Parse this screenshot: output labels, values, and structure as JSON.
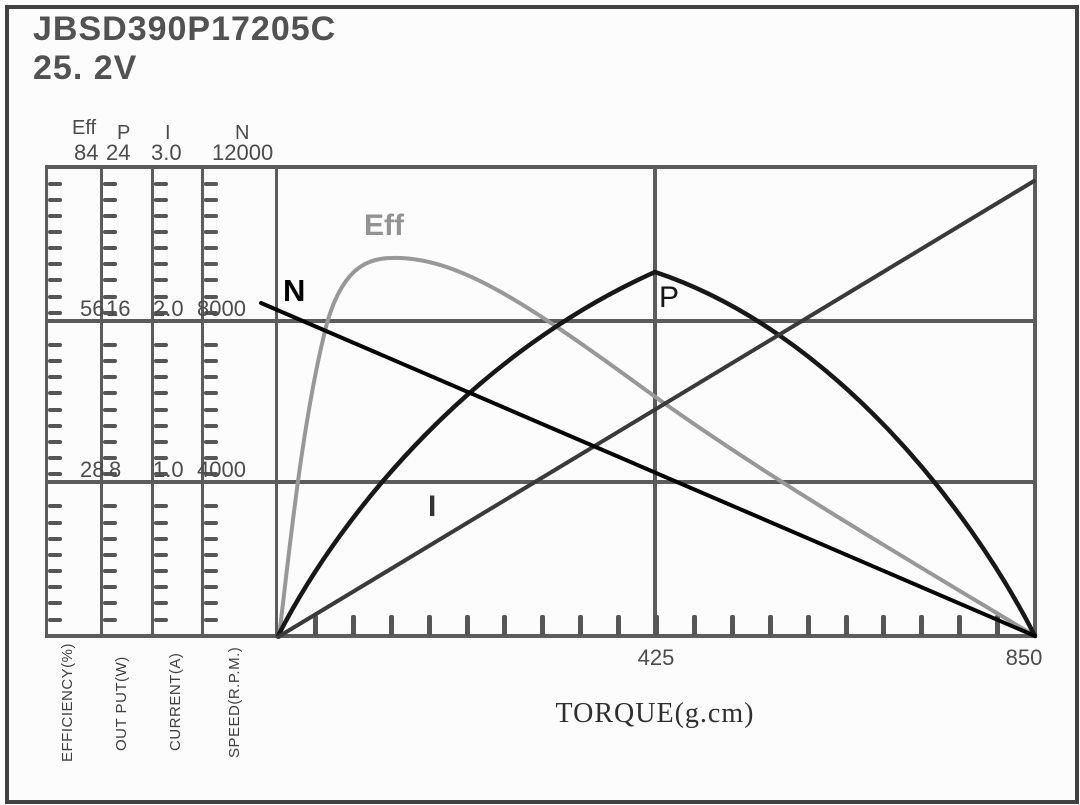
{
  "title": {
    "model": "JBSD390P17205C",
    "voltage": "25. 2V"
  },
  "left_axes": [
    {
      "name": "Eff",
      "top_value": "84",
      "mid_value": "56",
      "low_value": "28",
      "unit_label": "EFFICIENCY(%)"
    },
    {
      "name": "P",
      "top_value": "24",
      "mid_value": "16",
      "low_value": "8",
      "unit_label": "OUT PUT(W)"
    },
    {
      "name": "I",
      "top_value": "3.0",
      "mid_value": "2.0",
      "low_value": "1.0",
      "unit_label": "CURRENT(A)"
    },
    {
      "name": "N",
      "top_value": "12000",
      "mid_value": "8000",
      "low_value": "4000",
      "unit_label": "SPEED(R.P.M.)"
    }
  ],
  "x_axis": {
    "label": "TORQUE(g.cm)",
    "mid_tick": "425",
    "end_tick": "850"
  },
  "curve_labels": {
    "eff": "Eff",
    "n": "N",
    "p": "P",
    "i": "I"
  },
  "colors": {
    "eff_curve": "#989898",
    "n_curve": "#050505",
    "p_curve": "#181818",
    "i_curve": "#3a3a3a",
    "grid": "#5c5c5c",
    "border": "#414141",
    "text": "#4c4c4c"
  },
  "chart_data": {
    "type": "line",
    "title": "JBSD390P17205C 25.2V motor performance curves",
    "xlabel": "TORQUE(g.cm)",
    "x_range": [
      0,
      850
    ],
    "x_ticks": [
      425,
      850
    ],
    "grid": "major horizontal at 1/3 and 2/3 of full scale, vertical at 425",
    "axes": [
      {
        "name": "Eff",
        "label": "EFFICIENCY(%)",
        "range": [
          0,
          84
        ],
        "ticks": [
          28,
          56,
          84
        ]
      },
      {
        "name": "P",
        "label": "OUT PUT(W)",
        "range": [
          0,
          24
        ],
        "ticks": [
          8,
          16,
          24
        ]
      },
      {
        "name": "I",
        "label": "CURRENT(A)",
        "range": [
          0,
          3.0
        ],
        "ticks": [
          1.0,
          2.0,
          3.0
        ]
      },
      {
        "name": "N",
        "label": "SPEED(R.P.M.)",
        "range": [
          0,
          12000
        ],
        "ticks": [
          4000,
          8000,
          12000
        ]
      }
    ],
    "series": [
      {
        "name": "N",
        "unit": "R.P.M.",
        "shape": "straight descending line",
        "points": [
          [
            0,
            8300
          ],
          [
            212,
            6230
          ],
          [
            425,
            4160
          ],
          [
            638,
            2080
          ],
          [
            850,
            0
          ]
        ]
      },
      {
        "name": "I",
        "unit": "A",
        "shape": "straight ascending line",
        "points": [
          [
            0,
            0.05
          ],
          [
            212,
            0.77
          ],
          [
            425,
            1.48
          ],
          [
            638,
            2.19
          ],
          [
            850,
            2.9
          ]
        ]
      },
      {
        "name": "P",
        "unit": "W",
        "shape": "parabolic arch, peak at 425 g.cm",
        "points": [
          [
            0,
            0
          ],
          [
            130,
            8.0
          ],
          [
            280,
            15.0
          ],
          [
            425,
            18.5
          ],
          [
            570,
            15.0
          ],
          [
            705,
            8.0
          ],
          [
            850,
            0
          ]
        ]
      },
      {
        "name": "Eff",
        "unit": "%",
        "shape": "steep rise to peak near 140 g.cm then near-linear fall",
        "points": [
          [
            0,
            0
          ],
          [
            23,
            28
          ],
          [
            55,
            56
          ],
          [
            140,
            67
          ],
          [
            410,
            44
          ],
          [
            577,
            28
          ],
          [
            850,
            0
          ]
        ]
      }
    ]
  }
}
